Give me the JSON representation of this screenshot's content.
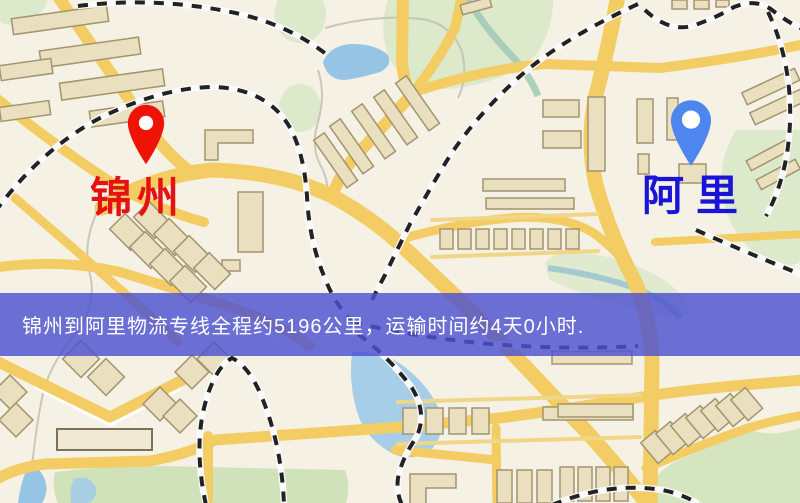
{
  "map": {
    "origin": {
      "label": "锦州",
      "pin_color": "#ee1306",
      "label_color": "#e61113"
    },
    "destination": {
      "label": "阿里",
      "pin_color": "#4c86ee",
      "label_color": "#1a13d8"
    },
    "banner": {
      "text": "锦州到阿里物流专线全程约5196公里，运输时间约4天0小时.",
      "bg_color": "#4d51cf",
      "text_color": "#ffffff"
    },
    "palette": {
      "background": "#f5f1e4",
      "road": "#f3cd63",
      "railway": "#222222",
      "water": "#96c4e4",
      "park": "#dce9ca",
      "building": "#eae0c0"
    }
  }
}
